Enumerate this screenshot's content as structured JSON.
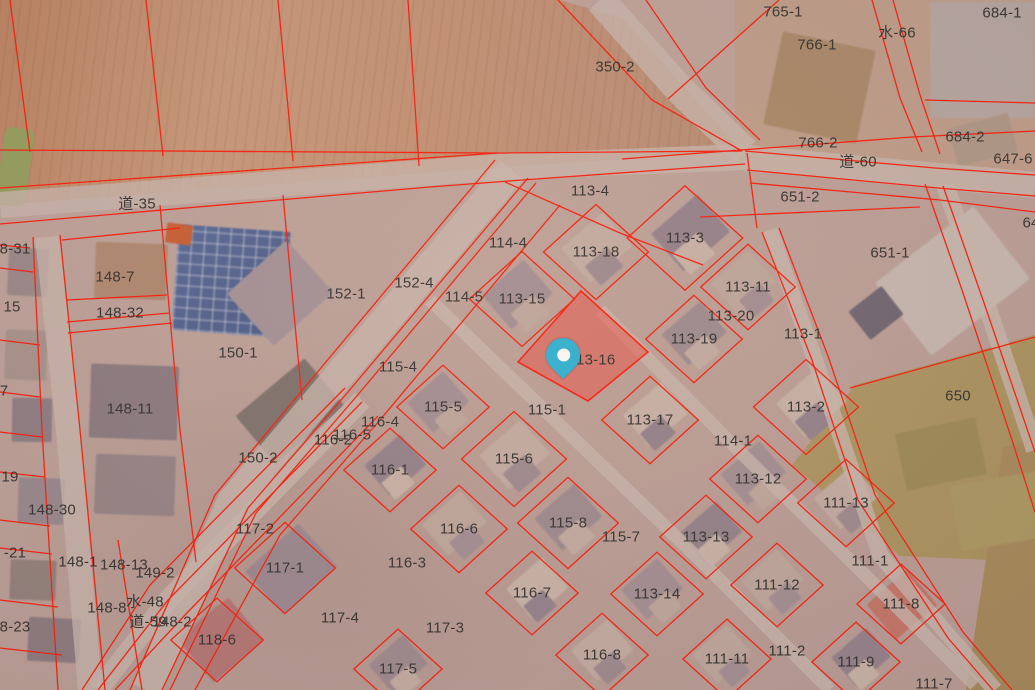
{
  "map": {
    "parcel_line_color": "#fb1f0e",
    "label_color": "#333333",
    "selected_parcel": {
      "id": "113-16",
      "fill": "#ef4d43",
      "fill_opacity": 0.5,
      "border": "#ff1f10"
    },
    "marker": {
      "type": "location-pin",
      "color": "#2bb5d8",
      "x": 563,
      "y": 380
    },
    "labels": [
      {
        "text": "765-1",
        "x": 783,
        "y": 12
      },
      {
        "text": "766-1",
        "x": 817,
        "y": 45
      },
      {
        "text": "684-1",
        "x": 1002,
        "y": 13
      },
      {
        "text": "水-66",
        "x": 897,
        "y": 33
      },
      {
        "text": "350-2",
        "x": 615,
        "y": 67
      },
      {
        "text": "766-2",
        "x": 818,
        "y": 143
      },
      {
        "text": "道-60",
        "x": 858,
        "y": 162
      },
      {
        "text": "684-2",
        "x": 965,
        "y": 137
      },
      {
        "text": "647-6",
        "x": 1013,
        "y": 159
      },
      {
        "text": "64",
        "x": 1031,
        "y": 223
      },
      {
        "text": "651-2",
        "x": 800,
        "y": 197
      },
      {
        "text": "651-1",
        "x": 890,
        "y": 253
      },
      {
        "text": "650",
        "x": 958,
        "y": 396
      },
      {
        "text": "道-35",
        "x": 137,
        "y": 204
      },
      {
        "text": "113-4",
        "x": 590,
        "y": 191
      },
      {
        "text": "114-4",
        "x": 508,
        "y": 243
      },
      {
        "text": "113-18",
        "x": 596,
        "y": 252
      },
      {
        "text": "113-3",
        "x": 685,
        "y": 238
      },
      {
        "text": "152-1",
        "x": 346,
        "y": 294
      },
      {
        "text": "152-4",
        "x": 414,
        "y": 283
      },
      {
        "text": "114-5",
        "x": 464,
        "y": 297
      },
      {
        "text": "113-15",
        "x": 522,
        "y": 299
      },
      {
        "text": "113-11",
        "x": 748,
        "y": 287
      },
      {
        "text": "113-20",
        "x": 731,
        "y": 316
      },
      {
        "text": "113-19",
        "x": 694,
        "y": 339
      },
      {
        "text": "113-1",
        "x": 803,
        "y": 334
      },
      {
        "text": "113-16",
        "x": 592,
        "y": 360
      },
      {
        "text": "113-2",
        "x": 806,
        "y": 407
      },
      {
        "text": "113-17",
        "x": 650,
        "y": 420
      },
      {
        "text": "115-1",
        "x": 547,
        "y": 410
      },
      {
        "text": "115-4",
        "x": 398,
        "y": 367
      },
      {
        "text": "115-5",
        "x": 443,
        "y": 407
      },
      {
        "text": "116-4",
        "x": 380,
        "y": 422
      },
      {
        "text": "116-5",
        "x": 352,
        "y": 435
      },
      {
        "text": "116-2",
        "x": 333,
        "y": 440
      },
      {
        "text": "116-1",
        "x": 390,
        "y": 470
      },
      {
        "text": "115-6",
        "x": 514,
        "y": 459
      },
      {
        "text": "116-6",
        "x": 459,
        "y": 529
      },
      {
        "text": "116-3",
        "x": 407,
        "y": 563
      },
      {
        "text": "116-7",
        "x": 532,
        "y": 593
      },
      {
        "text": "115-8",
        "x": 568,
        "y": 523
      },
      {
        "text": "115-7",
        "x": 621,
        "y": 537
      },
      {
        "text": "114-1",
        "x": 733,
        "y": 441
      },
      {
        "text": "113-12",
        "x": 758,
        "y": 479
      },
      {
        "text": "111-13",
        "x": 846,
        "y": 503
      },
      {
        "text": "113-13",
        "x": 706,
        "y": 537
      },
      {
        "text": "113-14",
        "x": 657,
        "y": 594
      },
      {
        "text": "111-12",
        "x": 777,
        "y": 585
      },
      {
        "text": "111-1",
        "x": 870,
        "y": 561
      },
      {
        "text": "111-8",
        "x": 901,
        "y": 604
      },
      {
        "text": "111-11",
        "x": 727,
        "y": 659
      },
      {
        "text": "111-2",
        "x": 787,
        "y": 651
      },
      {
        "text": "111-9",
        "x": 856,
        "y": 662
      },
      {
        "text": "111-7",
        "x": 934,
        "y": 684
      },
      {
        "text": "116-8",
        "x": 602,
        "y": 655
      },
      {
        "text": "117-3",
        "x": 445,
        "y": 628
      },
      {
        "text": "117-5",
        "x": 398,
        "y": 669
      },
      {
        "text": "117-4",
        "x": 340,
        "y": 618
      },
      {
        "text": "117-2",
        "x": 255,
        "y": 529
      },
      {
        "text": "117-1",
        "x": 285,
        "y": 568
      },
      {
        "text": "118-6",
        "x": 217,
        "y": 640
      },
      {
        "text": "150-2",
        "x": 258,
        "y": 458
      },
      {
        "text": "150-1",
        "x": 238,
        "y": 353
      },
      {
        "text": "148-7",
        "x": 115,
        "y": 277
      },
      {
        "text": "148-32",
        "x": 120,
        "y": 313
      },
      {
        "text": "148-11",
        "x": 130,
        "y": 409
      },
      {
        "text": "148-30",
        "x": 52,
        "y": 510
      },
      {
        "text": "148-1",
        "x": 78,
        "y": 562
      },
      {
        "text": "148-13",
        "x": 124,
        "y": 565
      },
      {
        "text": "149-2",
        "x": 155,
        "y": 573
      },
      {
        "text": "148-8",
        "x": 107,
        "y": 608
      },
      {
        "text": "水-48",
        "x": 145,
        "y": 602
      },
      {
        "text": "道-59",
        "x": 148,
        "y": 622
      },
      {
        "text": "148-2",
        "x": 172,
        "y": 622
      },
      {
        "text": "8-31",
        "x": 15,
        "y": 249
      },
      {
        "text": "15",
        "x": 12,
        "y": 307
      },
      {
        "text": "7",
        "x": 4,
        "y": 391
      },
      {
        "text": "19",
        "x": 10,
        "y": 477
      },
      {
        "text": "-21",
        "x": 15,
        "y": 553
      },
      {
        "text": "8-23",
        "x": 15,
        "y": 627
      }
    ]
  }
}
